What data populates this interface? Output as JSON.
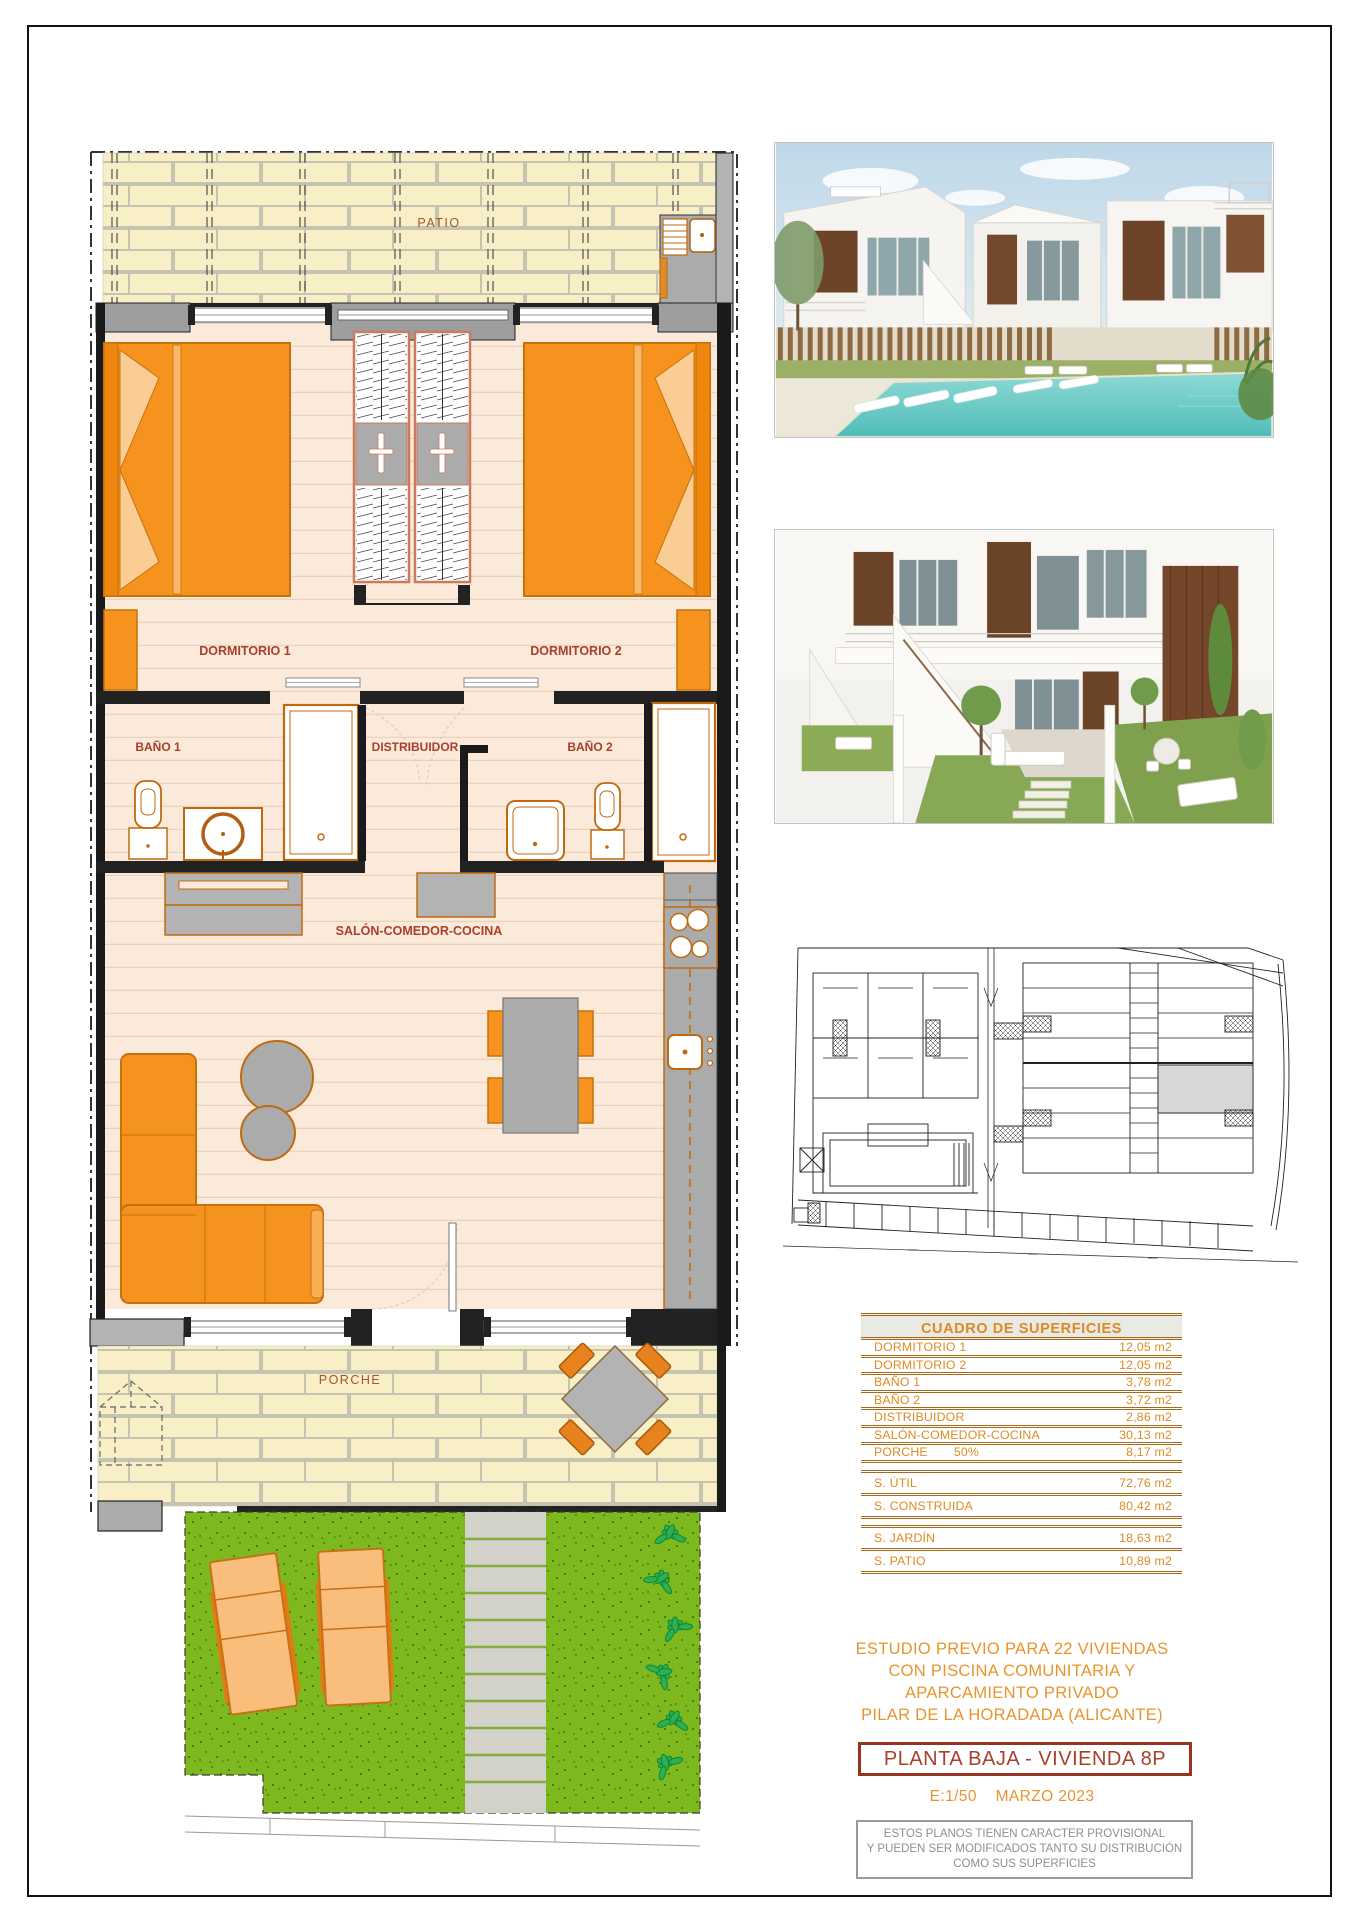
{
  "floor_plan": {
    "rooms": {
      "patio": "PATIO",
      "dormitorio1": "DORMITORIO 1",
      "dormitorio2": "DORMITORIO 2",
      "bano1": "BAÑO 1",
      "bano2": "BAÑO 2",
      "distribuidor": "DISTRIBUIDOR",
      "salon": "SALÓN-COMEDOR-COCINA",
      "porche": "PORCHE"
    }
  },
  "surface_table": {
    "title": "CUADRO DE SUPERFICIES",
    "rows": [
      {
        "label": "DORMITORIO 1",
        "value": "12,05 m2"
      },
      {
        "label": "DORMITORIO 2",
        "value": "12,05 m2"
      },
      {
        "label": "BAÑO 1",
        "value": "3,78 m2"
      },
      {
        "label": "BAÑO 2",
        "value": "3,72 m2"
      },
      {
        "label": "DISTRIBUIDOR",
        "value": "2,86 m2"
      },
      {
        "label": "SALÓN-COMEDOR-COCINA",
        "value": "30,13 m2"
      },
      {
        "label": "PORCHE",
        "note": "50%",
        "value": "8,17 m2"
      }
    ],
    "totals": [
      {
        "label": "S. ÚTIL",
        "value": "72,76 m2"
      },
      {
        "label": "S. CONSTRUIDA",
        "value": "80,42 m2"
      },
      {
        "label": "S. JARDÍN",
        "value": "18,63 m2"
      },
      {
        "label": "S. PATIO",
        "value": "10,89 m2"
      }
    ]
  },
  "project": {
    "title_lines": [
      "ESTUDIO PREVIO PARA 22 VIVIENDAS",
      "CON PISCINA COMUNITARIA Y",
      "APARCAMIENTO PRIVADO",
      "PILAR DE LA HORADADA (ALICANTE)"
    ],
    "plan_label": "PLANTA BAJA - VIVIENDA 8P",
    "scale": "E:1/50",
    "date": "MARZO 2023",
    "disclaimer_lines": [
      "ESTOS PLANOS TIENEN CARACTER PROVISIONAL",
      "Y PUEDEN SER MODIFICADOS TANTO SU DISTRIBUCIÓN",
      "COMO SUS SUPERFICIES"
    ]
  },
  "colors": {
    "furniture_orange": "#F6921E",
    "furniture_border": "#C4730A",
    "label_red": "#A8402C",
    "table_orange": "#DE8A22",
    "table_rule_brown": "#A86A1A",
    "title_orange": "#E8942C",
    "plan_box_red": "#943522",
    "disclaimer_gray": "#8F8F8F",
    "wall_gray": "#B3B3B3",
    "wall_black": "#1A1A1A",
    "floor_fill": "#FBE9DA",
    "brick_fill": "#F8EFC6",
    "garden_green": "#7DB91E",
    "pool_teal": "#5FC8C2",
    "corten_brown": "#74462A"
  }
}
